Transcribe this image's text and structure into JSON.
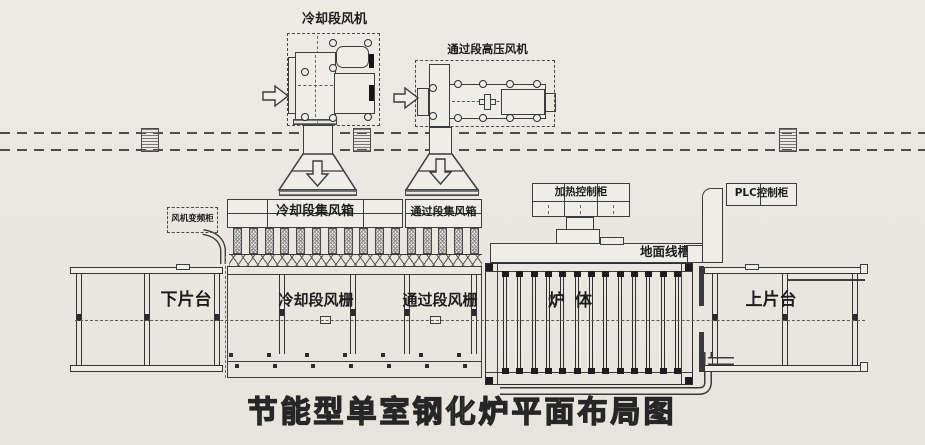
{
  "title": "节能型单室钢化炉平面布局图",
  "fans": {
    "cooling": {
      "label": "冷却段风机"
    },
    "pass": {
      "label": "通过段高压风机"
    }
  },
  "cabinets": {
    "vfd": {
      "label": "风机变频柜"
    },
    "heating": {
      "label": "加热控制柜"
    },
    "plc": {
      "label": "PLC控制柜"
    }
  },
  "ducts": {
    "floor_trough": {
      "label": "地面线槽"
    }
  },
  "plenums": {
    "cooling": {
      "label": "冷却段集风箱"
    },
    "pass": {
      "label": "通过段集风箱"
    }
  },
  "grids": {
    "cooling": {
      "label": "冷却段风栅"
    },
    "pass": {
      "label": "通过段风栅"
    }
  },
  "furnace": {
    "label": "炉体"
  },
  "tables": {
    "unload": {
      "label": "下片台"
    },
    "load": {
      "label": "上片台"
    }
  },
  "colors": {
    "paper": "#ebe8e2",
    "line": "#3d3d3d"
  }
}
